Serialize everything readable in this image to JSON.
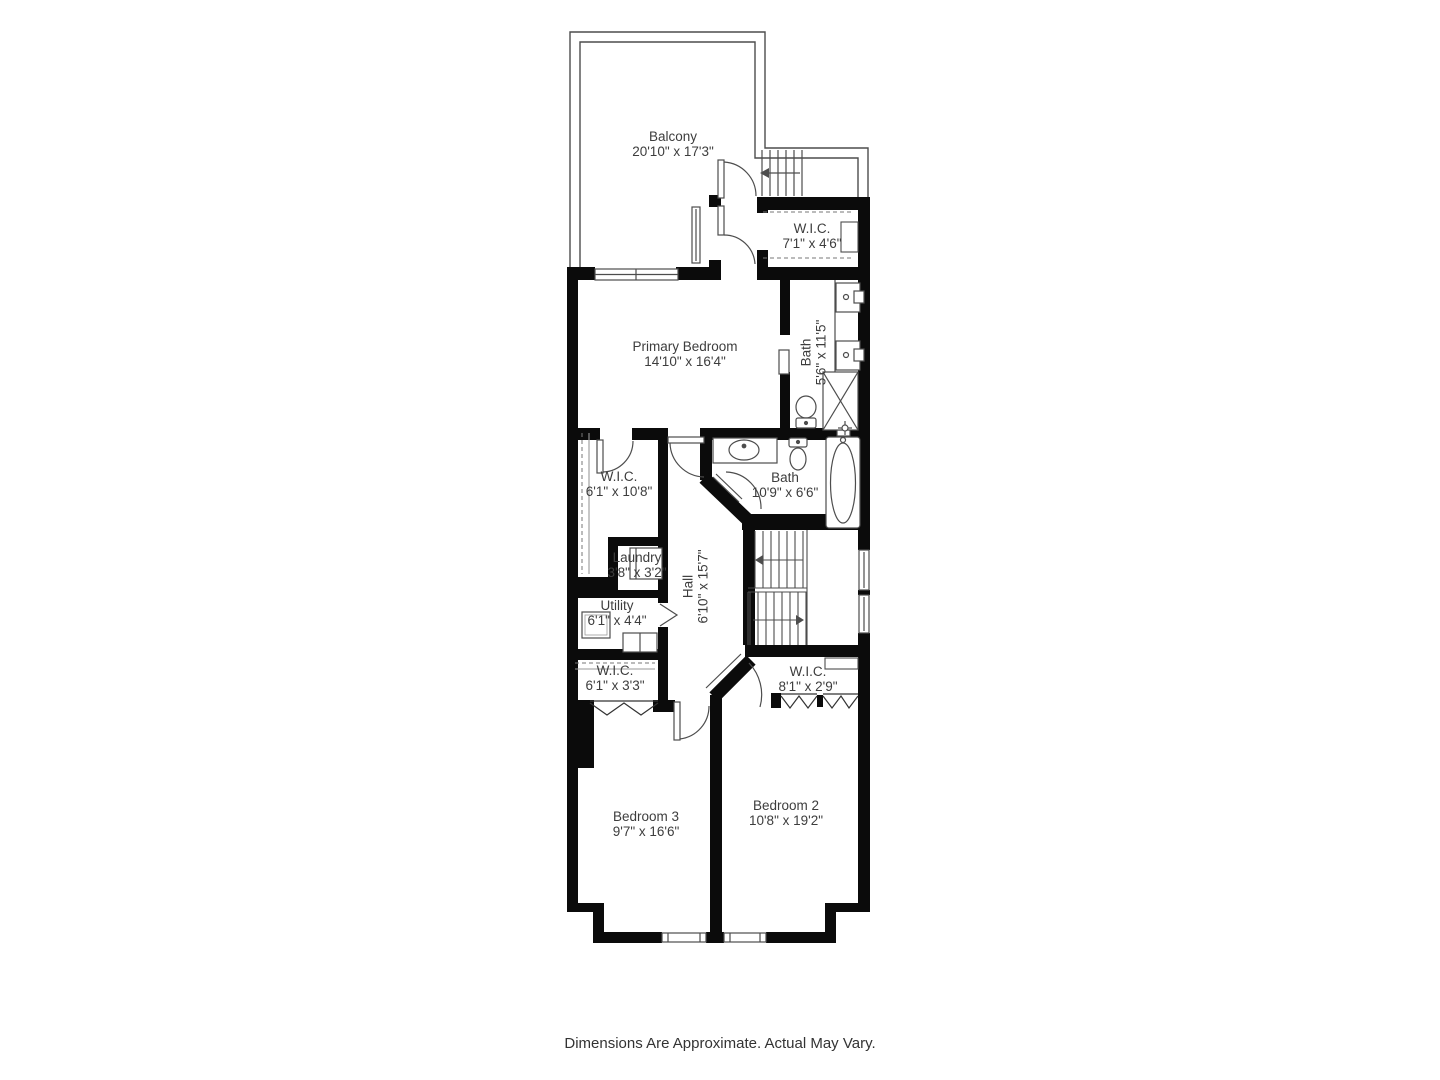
{
  "caption": "Dimensions Are Approximate. Actual May Vary.",
  "colors": {
    "wall": "#0b0b0b",
    "thin_line": "#4d4d4d",
    "text": "#3d3d3d",
    "background": "#ffffff"
  },
  "rooms": {
    "balcony": {
      "name": "Balcony",
      "dims": "20'10\" x 17'3\""
    },
    "wic_top": {
      "name": "W.I.C.",
      "dims": "7'1\" x 4'6\""
    },
    "primary_bedroom": {
      "name": "Primary Bedroom",
      "dims": "14'10\" x 16'4\""
    },
    "primary_bath": {
      "name": "Bath",
      "dims": "5'6\" x 11'5\""
    },
    "wic_left": {
      "name": "W.I.C.",
      "dims": "6'1\" x 10'8\""
    },
    "bath": {
      "name": "Bath",
      "dims": "10'9\" x 6'6\""
    },
    "laundry": {
      "name": "Laundry",
      "dims": "3'8\" x 3'2\""
    },
    "hall": {
      "name": "Hall",
      "dims": "6'10\" x 15'7\""
    },
    "utility": {
      "name": "Utility",
      "dims": "6'1\" x 4'4\""
    },
    "wic_bedroom3": {
      "name": "W.I.C.",
      "dims": "6'1\" x 3'3\""
    },
    "wic_bedroom2": {
      "name": "W.I.C.",
      "dims": "8'1\" x 2'9\""
    },
    "bedroom3": {
      "name": "Bedroom 3",
      "dims": "9'7\" x 16'6\""
    },
    "bedroom2": {
      "name": "Bedroom 2",
      "dims": "10'8\" x 19'2\""
    }
  }
}
